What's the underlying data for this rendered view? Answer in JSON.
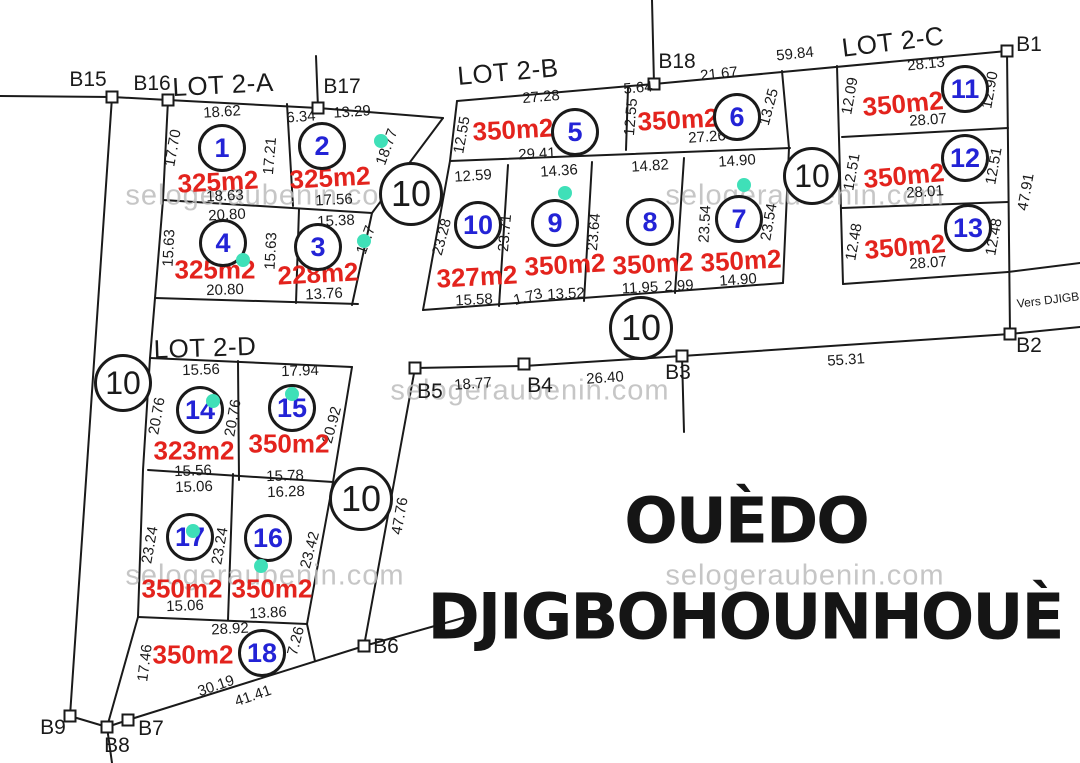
{
  "title": {
    "line1": "OUÈDO",
    "line2": "DJIGBOHOUNHOUÈ"
  },
  "colors": {
    "area_red": "#e3231d",
    "plot_blue": "#2323d6",
    "dot_green": "#3fe0b8",
    "line_black": "#1a1a1a",
    "watermark_gray": "#bdbdbd",
    "title_black": "#151515"
  },
  "lot_titles": [
    {
      "t": "LOT 2-A",
      "x": 223,
      "y": 85,
      "r": -3
    },
    {
      "t": "LOT 2-B",
      "x": 508,
      "y": 72,
      "r": -5
    },
    {
      "t": "LOT 2-C",
      "x": 893,
      "y": 42,
      "r": -7
    },
    {
      "t": "LOT 2-D",
      "x": 205,
      "y": 348,
      "r": -2
    }
  ],
  "plot_numbers": [
    {
      "t": "1",
      "x": 222,
      "y": 148
    },
    {
      "t": "2",
      "x": 322,
      "y": 146
    },
    {
      "t": "3",
      "x": 318,
      "y": 247
    },
    {
      "t": "4",
      "x": 223,
      "y": 243
    },
    {
      "t": "5",
      "x": 575,
      "y": 132
    },
    {
      "t": "6",
      "x": 737,
      "y": 117
    },
    {
      "t": "7",
      "x": 739,
      "y": 219
    },
    {
      "t": "8",
      "x": 650,
      "y": 222
    },
    {
      "t": "9",
      "x": 555,
      "y": 223
    },
    {
      "t": "10",
      "x": 478,
      "y": 225
    },
    {
      "t": "11",
      "x": 965,
      "y": 89
    },
    {
      "t": "12",
      "x": 965,
      "y": 158
    },
    {
      "t": "13",
      "x": 968,
      "y": 228
    },
    {
      "t": "14",
      "x": 200,
      "y": 410
    },
    {
      "t": "15",
      "x": 292,
      "y": 408
    },
    {
      "t": "16",
      "x": 268,
      "y": 538
    },
    {
      "t": "17",
      "x": 190,
      "y": 537
    },
    {
      "t": "18",
      "x": 262,
      "y": 653
    }
  ],
  "areas": [
    {
      "t": "325m2",
      "x": 218,
      "y": 182,
      "r": -3
    },
    {
      "t": "325m2",
      "x": 330,
      "y": 178,
      "r": -3
    },
    {
      "t": "228m2",
      "x": 318,
      "y": 274,
      "r": -3
    },
    {
      "t": "325m2",
      "x": 215,
      "y": 270,
      "r": 0
    },
    {
      "t": "350m2",
      "x": 513,
      "y": 130,
      "r": -3
    },
    {
      "t": "350m2",
      "x": 678,
      "y": 120,
      "r": -3
    },
    {
      "t": "350m2",
      "x": 741,
      "y": 261,
      "r": -3
    },
    {
      "t": "350m2",
      "x": 653,
      "y": 264,
      "r": -3
    },
    {
      "t": "350m2",
      "x": 565,
      "y": 265,
      "r": -3
    },
    {
      "t": "327m2",
      "x": 477,
      "y": 277,
      "r": -3
    },
    {
      "t": "350m2",
      "x": 903,
      "y": 104,
      "r": -5
    },
    {
      "t": "350m2",
      "x": 904,
      "y": 176,
      "r": -5
    },
    {
      "t": "350m2",
      "x": 905,
      "y": 247,
      "r": -5
    },
    {
      "t": "323m2",
      "x": 194,
      "y": 451,
      "r": 0
    },
    {
      "t": "350m2",
      "x": 289,
      "y": 444,
      "r": 0
    },
    {
      "t": "350m2",
      "x": 272,
      "y": 589,
      "r": 0
    },
    {
      "t": "350m2",
      "x": 182,
      "y": 589,
      "r": 0
    },
    {
      "t": "350m2",
      "x": 193,
      "y": 655,
      "r": 0
    }
  ],
  "dimensions": [
    {
      "t": "18.62",
      "x": 222,
      "y": 112,
      "r": -4
    },
    {
      "t": "6.34",
      "x": 301,
      "y": 117,
      "r": -4
    },
    {
      "t": "13.29",
      "x": 352,
      "y": 112,
      "r": -4
    },
    {
      "t": "17.70",
      "x": 173,
      "y": 148,
      "r": -80
    },
    {
      "t": "17.21",
      "x": 270,
      "y": 156,
      "r": -85
    },
    {
      "t": "18.77",
      "x": 387,
      "y": 147,
      "r": -70
    },
    {
      "t": "18.63",
      "x": 225,
      "y": 196,
      "r": -3
    },
    {
      "t": "17.56",
      "x": 334,
      "y": 200,
      "r": -3
    },
    {
      "t": "20.80",
      "x": 227,
      "y": 215,
      "r": -3
    },
    {
      "t": "15.38",
      "x": 336,
      "y": 221,
      "r": -3
    },
    {
      "t": "15.63",
      "x": 169,
      "y": 248,
      "r": -87
    },
    {
      "t": "15.63",
      "x": 271,
      "y": 251,
      "r": -87
    },
    {
      "t": "15.7",
      "x": 366,
      "y": 240,
      "r": -70
    },
    {
      "t": "20.80",
      "x": 225,
      "y": 290,
      "r": -2
    },
    {
      "t": "13.76",
      "x": 324,
      "y": 294,
      "r": -3
    },
    {
      "t": "27.28",
      "x": 541,
      "y": 97,
      "r": -5
    },
    {
      "t": "5.64",
      "x": 638,
      "y": 88,
      "r": -5
    },
    {
      "t": "21.67",
      "x": 719,
      "y": 74,
      "r": -6
    },
    {
      "t": "12.55",
      "x": 462,
      "y": 135,
      "r": -80
    },
    {
      "t": "12.55",
      "x": 631,
      "y": 117,
      "r": -85
    },
    {
      "t": "13.25",
      "x": 769,
      "y": 107,
      "r": -75
    },
    {
      "t": "29.41",
      "x": 537,
      "y": 154,
      "r": -3
    },
    {
      "t": "27.26",
      "x": 707,
      "y": 137,
      "r": -4
    },
    {
      "t": "12.59",
      "x": 473,
      "y": 176,
      "r": -4
    },
    {
      "t": "14.36",
      "x": 559,
      "y": 171,
      "r": -4
    },
    {
      "t": "14.82",
      "x": 650,
      "y": 166,
      "r": -4
    },
    {
      "t": "14.90",
      "x": 737,
      "y": 161,
      "r": -4
    },
    {
      "t": "23.28",
      "x": 442,
      "y": 237,
      "r": -75
    },
    {
      "t": "23.71",
      "x": 505,
      "y": 233,
      "r": -85
    },
    {
      "t": "23.64",
      "x": 594,
      "y": 232,
      "r": -85
    },
    {
      "t": "23.54",
      "x": 705,
      "y": 224,
      "r": -87
    },
    {
      "t": "23.54",
      "x": 769,
      "y": 222,
      "r": -80
    },
    {
      "t": "15.58",
      "x": 474,
      "y": 300,
      "r": -3
    },
    {
      "t": "1.73",
      "x": 528,
      "y": 297,
      "r": -15
    },
    {
      "t": "13.52",
      "x": 566,
      "y": 294,
      "r": -3
    },
    {
      "t": "11.95",
      "x": 640,
      "y": 288,
      "r": -3
    },
    {
      "t": "2.99",
      "x": 679,
      "y": 286,
      "r": -3
    },
    {
      "t": "14.90",
      "x": 738,
      "y": 280,
      "r": -4
    },
    {
      "t": "59.84",
      "x": 795,
      "y": 54,
      "r": -6
    },
    {
      "t": "28.13",
      "x": 926,
      "y": 64,
      "r": -6
    },
    {
      "t": "12.09",
      "x": 850,
      "y": 96,
      "r": -80
    },
    {
      "t": "12.90",
      "x": 990,
      "y": 90,
      "r": -80
    },
    {
      "t": "28.07",
      "x": 928,
      "y": 120,
      "r": -4
    },
    {
      "t": "12.51",
      "x": 852,
      "y": 172,
      "r": -80
    },
    {
      "t": "12.51",
      "x": 994,
      "y": 166,
      "r": -80
    },
    {
      "t": "28.01",
      "x": 925,
      "y": 192,
      "r": -4
    },
    {
      "t": "47.91",
      "x": 1026,
      "y": 192,
      "r": -80
    },
    {
      "t": "12.48",
      "x": 854,
      "y": 242,
      "r": -80
    },
    {
      "t": "12.48",
      "x": 994,
      "y": 237,
      "r": -80
    },
    {
      "t": "28.07",
      "x": 928,
      "y": 263,
      "r": -4
    },
    {
      "t": "Vers DJIGB",
      "x": 1048,
      "y": 300,
      "r": -7,
      "s": 12
    },
    {
      "t": "55.31",
      "x": 846,
      "y": 360,
      "r": -4
    },
    {
      "t": "18.77",
      "x": 473,
      "y": 384,
      "r": -4
    },
    {
      "t": "26.40",
      "x": 605,
      "y": 378,
      "r": -4
    },
    {
      "t": "47.76",
      "x": 400,
      "y": 516,
      "r": -80
    },
    {
      "t": "15.56",
      "x": 201,
      "y": 370,
      "r": -2
    },
    {
      "t": "17.94",
      "x": 300,
      "y": 371,
      "r": -2
    },
    {
      "t": "20.76",
      "x": 157,
      "y": 416,
      "r": -80
    },
    {
      "t": "20.76",
      "x": 233,
      "y": 418,
      "r": -80
    },
    {
      "t": "20.92",
      "x": 332,
      "y": 425,
      "r": -75
    },
    {
      "t": "15.56",
      "x": 193,
      "y": 471,
      "r": -2
    },
    {
      "t": "15.78",
      "x": 285,
      "y": 476,
      "r": -2
    },
    {
      "t": "15.06",
      "x": 194,
      "y": 487,
      "r": -2
    },
    {
      "t": "16.28",
      "x": 286,
      "y": 492,
      "r": -2
    },
    {
      "t": "23.24",
      "x": 150,
      "y": 545,
      "r": -80
    },
    {
      "t": "23.24",
      "x": 220,
      "y": 546,
      "r": -80
    },
    {
      "t": "23.42",
      "x": 310,
      "y": 550,
      "r": -75
    },
    {
      "t": "15.06",
      "x": 185,
      "y": 606,
      "r": -2
    },
    {
      "t": "13.86",
      "x": 268,
      "y": 613,
      "r": -3
    },
    {
      "t": "28.92",
      "x": 230,
      "y": 629,
      "r": -3
    },
    {
      "t": "7.26",
      "x": 296,
      "y": 641,
      "r": -75
    },
    {
      "t": "17.46",
      "x": 145,
      "y": 663,
      "r": -83
    },
    {
      "t": "30.19",
      "x": 216,
      "y": 686,
      "r": -19
    },
    {
      "t": "41.41",
      "x": 253,
      "y": 696,
      "r": -19
    }
  ],
  "boundary_points": [
    {
      "t": "B15",
      "x": 88,
      "y": 80
    },
    {
      "t": "B16",
      "x": 152,
      "y": 84
    },
    {
      "t": "B17",
      "x": 342,
      "y": 87
    },
    {
      "t": "B18",
      "x": 677,
      "y": 62
    },
    {
      "t": "B1",
      "x": 1029,
      "y": 45
    },
    {
      "t": "B2",
      "x": 1029,
      "y": 346
    },
    {
      "t": "B3",
      "x": 678,
      "y": 373
    },
    {
      "t": "B4",
      "x": 540,
      "y": 386
    },
    {
      "t": "B5",
      "x": 430,
      "y": 392
    },
    {
      "t": "B6",
      "x": 386,
      "y": 647
    },
    {
      "t": "B7",
      "x": 151,
      "y": 729
    },
    {
      "t": "B8",
      "x": 117,
      "y": 746
    },
    {
      "t": "B9",
      "x": 53,
      "y": 728
    }
  ],
  "road_badges": [
    {
      "t": "10",
      "x": 123,
      "y": 383,
      "d": 52
    },
    {
      "t": "10",
      "x": 411,
      "y": 194,
      "d": 58
    },
    {
      "t": "10",
      "x": 641,
      "y": 328,
      "d": 58
    },
    {
      "t": "10",
      "x": 812,
      "y": 176,
      "d": 52
    },
    {
      "t": "10",
      "x": 361,
      "y": 499,
      "d": 58
    }
  ],
  "watermarks": [
    {
      "t": "selogeraubenin.com",
      "x": 265,
      "y": 196
    },
    {
      "t": "selogeraubenin.com",
      "x": 805,
      "y": 196
    },
    {
      "t": "selogeraubenin.com",
      "x": 530,
      "y": 391
    },
    {
      "t": "selogeraubenin.com",
      "x": 265,
      "y": 576
    },
    {
      "t": "selogeraubenin.com",
      "x": 805,
      "y": 576
    }
  ]
}
